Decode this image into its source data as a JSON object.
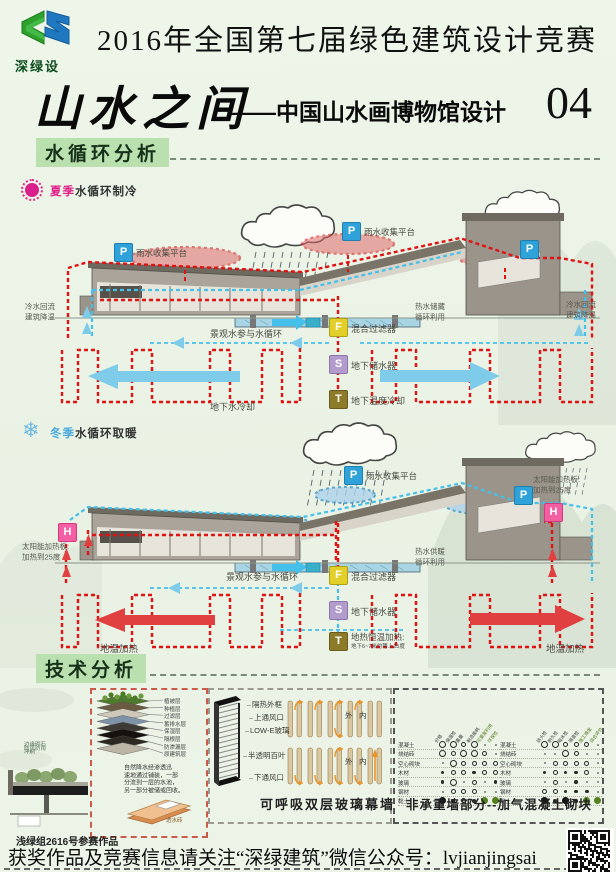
{
  "page": {
    "accent_red": "#e01212",
    "accent_blue": "#45c0ea",
    "accent_pink": "#e0218a",
    "accent_winter": "#4aa8dc"
  },
  "header": {
    "logo_text": "深绿设",
    "competition_title": "2016年全国第七届绿色建筑设计竞赛",
    "main_title": "山水之间",
    "subtitle": "——中国山水画博物馆设计",
    "entry_number": "04"
  },
  "section_water": {
    "title": "水循环分析"
  },
  "section_tech": {
    "title": "技术分析"
  },
  "summer": {
    "season": "夏季",
    "season_rest": "水循环制冷",
    "platform_label_1": "雨水收集平台",
    "platform_label_2": "雨水收集平台",
    "cold_return_left_1": "冷水回流",
    "cold_return_left_2": "建筑降温",
    "cold_return_right_1": "冷水回流",
    "cold_return_right_2": "建筑降温",
    "landscape": "景观水参与水循环",
    "hot_storage_1": "热水储藏",
    "hot_storage_2": "循环利用",
    "filter": "混合过滤器",
    "storage": "地下储水器",
    "temp_cool": "地下温度冷却",
    "ground_cool": "地下水冷却",
    "badge_p": "P",
    "badge_f": "F",
    "badge_s": "S",
    "badge_t": "T"
  },
  "winter": {
    "season": "冬季",
    "season_rest": "水循环取暖",
    "snow_icon": "❄",
    "platform_label": "雨水收集平台",
    "solar_left_1": "太阳能加热板:",
    "solar_left_2": "加热到25度",
    "solar_right_1": "太阳能加热板:",
    "solar_right_2": "加热到25度",
    "landscape": "景观水参与水循环",
    "hot_supply_1": "热水供暖",
    "hot_supply_2": "循环利用",
    "filter": "混合过滤器",
    "storage": "地下储水器",
    "geo_heat_1": "地热恒温加热:",
    "geo_heat_2": "地下6~7米约等上15度",
    "ground_heat_left": "地温加热",
    "ground_heat_right": "地温加热",
    "badge_p": "P",
    "badge_h": "H",
    "badge_f": "F",
    "badge_s": "S",
    "badge_t": "T"
  },
  "tech": {
    "roof_layers": [
      "植被层",
      "种植层",
      "过滤层",
      "蓄排水层",
      "保湿层",
      "隔根层",
      "防渗漏层",
      "原建筑层"
    ],
    "edge_note": [
      "边缘砌石",
      "防风防雨",
      "冲刷"
    ],
    "roof_text": [
      "自然降水经渗透迅",
      "速地通过铺装，一部",
      "分流到一层的水池，",
      "另一部分被储或回收。"
    ],
    "permeable_brick": "透水砖",
    "glass": {
      "caption": "可呼吸双层玻璃幕墙",
      "labels": [
        "隔热外框",
        "上通风口",
        "LOW-E玻璃",
        "半透明百叶",
        "下通风口"
      ],
      "outside": "外",
      "inside": "内",
      "cells": [
        "t",
        "t",
        "tb",
        "t",
        "n",
        "b",
        "b",
        "bt",
        "b",
        "u"
      ]
    },
    "wall": {
      "caption": "非承重墙部分--加气混凝土砌块",
      "rows": [
        "混凝土",
        "烧结砖",
        "空心砌块",
        "木材",
        "玻璃",
        "钢材",
        "黏土"
      ],
      "left_cols": [
        "价格",
        "保温性",
        "重量",
        "制造能耗",
        "可重复利用",
        "环保性"
      ],
      "right_cols": [
        "防火性",
        "耐久性",
        "吸水性",
        "隔音性",
        "施工难度",
        "综合评价"
      ],
      "left_matrix": [
        [
          "L",
          "L",
          "M",
          "L",
          "-",
          "-"
        ],
        [
          "L",
          "M",
          "L",
          "L",
          "M",
          "-"
        ],
        [
          "-",
          "L",
          "M",
          "M",
          "M",
          "M"
        ],
        [
          "S",
          "M",
          "M",
          "S",
          "M",
          "M"
        ],
        [
          "S",
          "L",
          "-",
          "M",
          "-",
          "S"
        ],
        [
          "-",
          "M",
          "M",
          "M",
          "-",
          "-"
        ],
        [
          "D",
          "S",
          "M",
          "S",
          "G",
          "G"
        ]
      ],
      "right_matrix": [
        [
          "L",
          "L",
          "M",
          "M",
          "M",
          "-"
        ],
        [
          "-",
          "-",
          "L",
          "M",
          "-",
          "-"
        ],
        [
          "-",
          "M",
          "M",
          "M",
          "M",
          "-"
        ],
        [
          "S",
          "M",
          "S",
          "S",
          "M",
          "-"
        ],
        [
          "-",
          "M",
          "-",
          "S",
          "-",
          "-"
        ],
        [
          "M",
          "M",
          "S",
          "S",
          "S",
          "-"
        ],
        [
          "D",
          "S",
          "D",
          "S",
          "G",
          "G"
        ]
      ]
    }
  },
  "footer": {
    "entry_note": "浅绿组2616号参赛作品",
    "wechat_line": "获奖作品及竞赛信息请关注“深绿建筑”微信公众号：lvjianjingsai"
  }
}
